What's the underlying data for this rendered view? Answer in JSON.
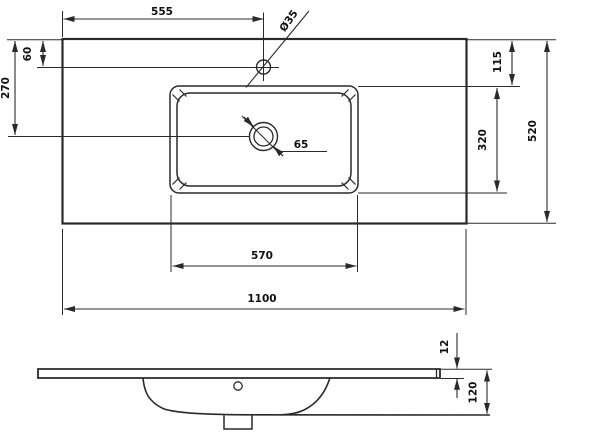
{
  "drawing": {
    "subject": "washbasin-countertop-technical-drawing",
    "colors": {
      "line": "#2a2a2a",
      "background": "#ffffff",
      "text": "#101010"
    },
    "top_view": {
      "total_width": "1100",
      "total_depth": "520",
      "faucet_offset_from_left": "555",
      "faucet_offset_from_front_edge": "60",
      "faucet_hole_diameter": "Ø35",
      "drain_offset_from_front_edge": "270",
      "drain_diameter": "65",
      "basin_offset_from_edge": "115",
      "basin_depth": "320",
      "basin_width": "570"
    },
    "side_view": {
      "slab_thickness": "12",
      "total_height": "120"
    }
  }
}
